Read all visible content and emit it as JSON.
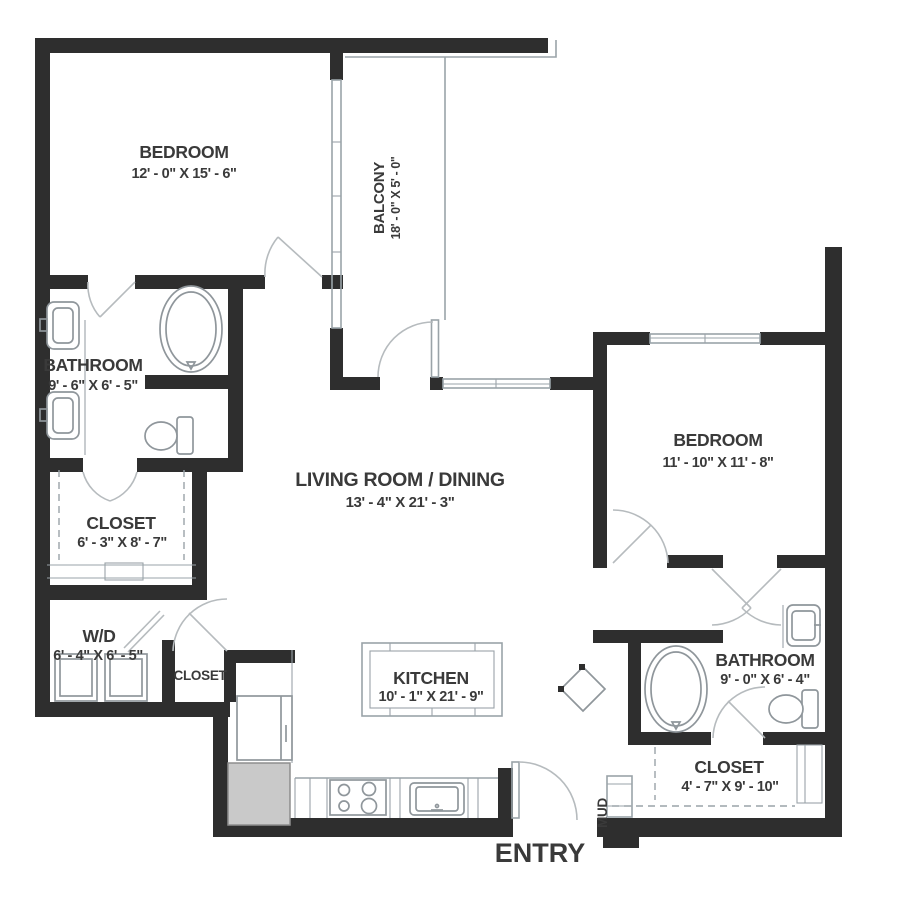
{
  "floorplan": {
    "rooms": {
      "bedroom1": {
        "label": "BEDROOM",
        "dims": "12' - 0\" X 15' - 6\""
      },
      "balcony": {
        "label": "BALCONY",
        "dims": "18' - 0\" X 5' - 0\""
      },
      "bathroom1": {
        "label": "BATHROOM",
        "dims": "9' - 6\" X 6' - 5\""
      },
      "closet1": {
        "label": "CLOSET",
        "dims": "6' - 3\" X 8' - 7\""
      },
      "living": {
        "label": "LIVING ROOM / DINING",
        "dims": "13' - 4\" X 21' - 3\""
      },
      "bedroom2": {
        "label": "BEDROOM",
        "dims": "11' - 10\" X 11' - 8\""
      },
      "laundry": {
        "label": "W/D",
        "dims": "6' - 4\" X 6' - 5\""
      },
      "closet_hall": {
        "label": "CLOSET"
      },
      "kitchen": {
        "label": "KITCHEN",
        "dims": "10' - 1\" X 21' - 9\""
      },
      "bathroom2": {
        "label": "BATHROOM",
        "dims": "9' - 0\" X 6' - 4\""
      },
      "closet2": {
        "label": "CLOSET",
        "dims": "4' - 7\" X 9' - 10\""
      },
      "mud": {
        "label": "MUD"
      },
      "entry": {
        "label": "ENTRY"
      }
    },
    "colors": {
      "wall": "#2e2e2e",
      "line": "#9aa3a8",
      "fixture": "#8f969b",
      "text": "#3a3a3a",
      "accent_fill": "#c9c9c9",
      "background": "#ffffff",
      "door": "#b6bbbe"
    }
  }
}
